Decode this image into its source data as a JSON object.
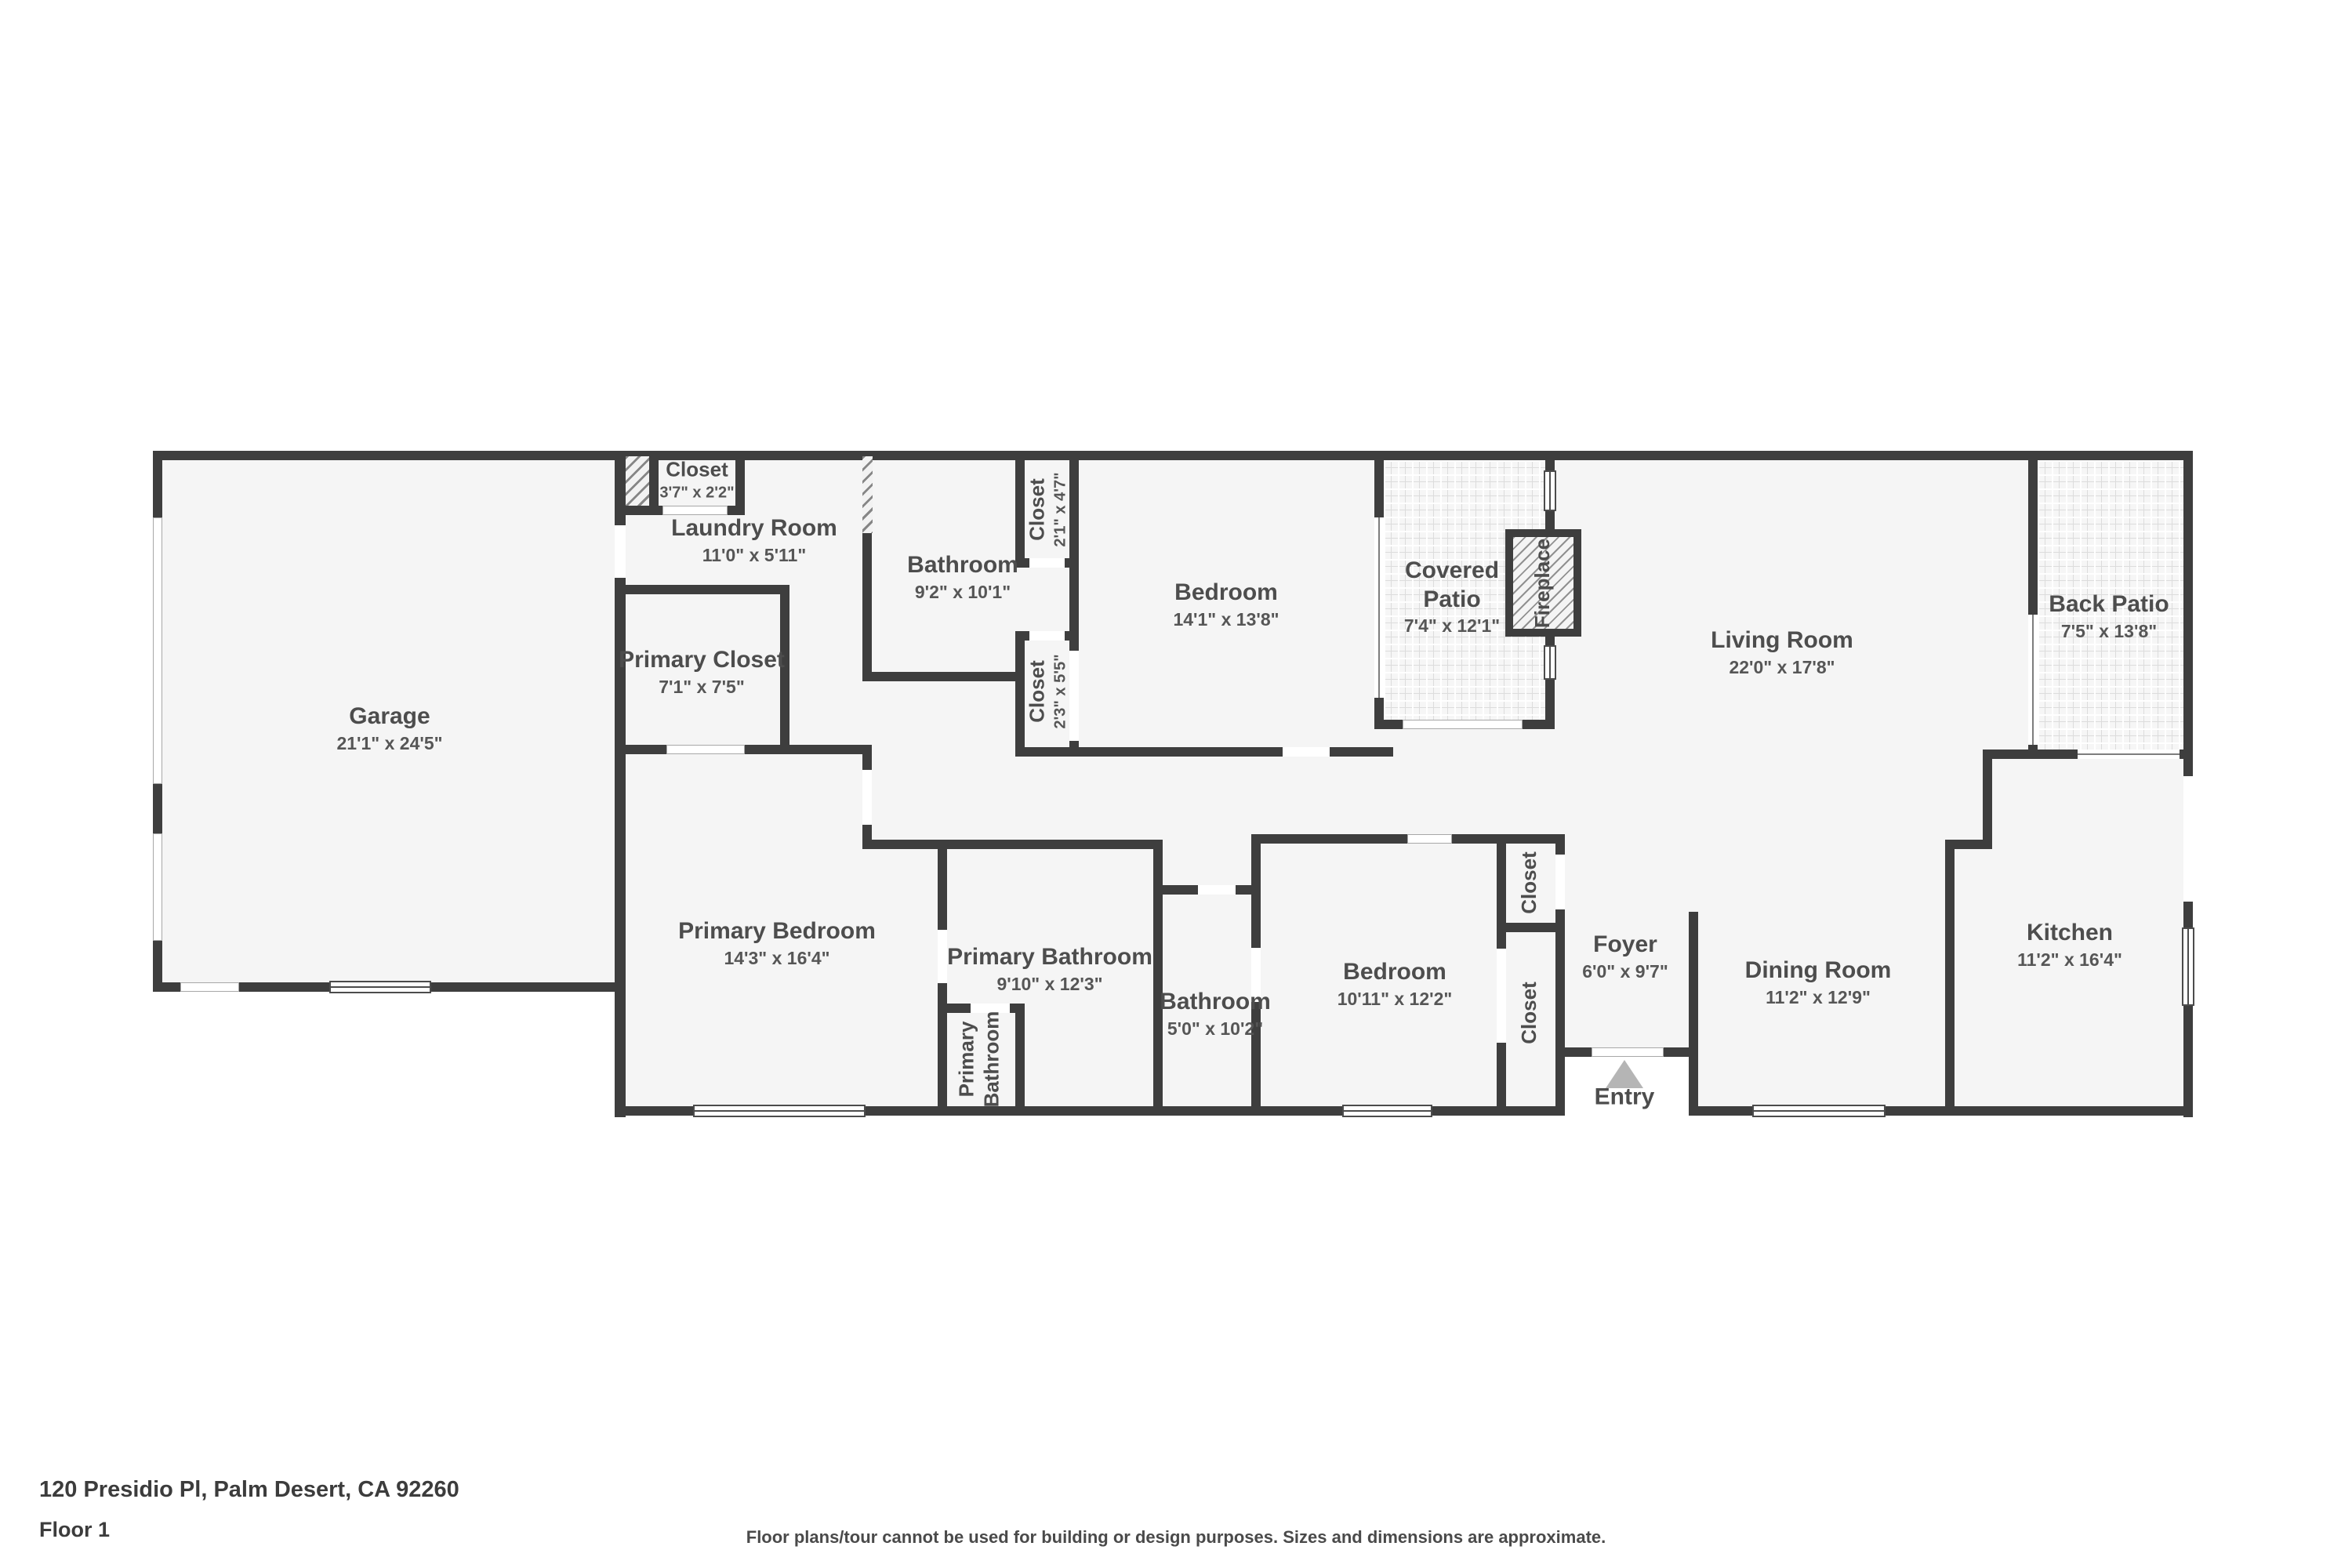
{
  "address": "120 Presidio Pl, Palm Desert, CA 92260",
  "floor_label": "Floor 1",
  "disclaimer": "Floor plans/tour cannot be used for building or design purposes. Sizes and dimensions are approximate.",
  "rooms": {
    "garage": {
      "name": "Garage",
      "dims": "21'1\" x 24'5\""
    },
    "closet_top": {
      "name": "Closet",
      "dims": "3'7\" x 2'2\""
    },
    "laundry": {
      "name": "Laundry Room",
      "dims": "11'0\" x 5'11\""
    },
    "bathroom_top": {
      "name": "Bathroom",
      "dims": "9'2\" x 10'1\""
    },
    "closet_21": {
      "name": "Closet",
      "dims": "2'1\" x 4'7\""
    },
    "closet_23": {
      "name": "Closet",
      "dims": "2'3\" x 5'5\""
    },
    "bedroom_top": {
      "name": "Bedroom",
      "dims": "14'1\" x 13'8\""
    },
    "covered_patio": {
      "name": "Covered Patio",
      "dims": "7'4\" x 12'1\""
    },
    "fireplace": {
      "name": "Fireplace"
    },
    "living": {
      "name": "Living Room",
      "dims": "22'0\" x 17'8\""
    },
    "back_patio": {
      "name": "Back Patio",
      "dims": "7'5\" x 13'8\""
    },
    "primary_closet": {
      "name": "Primary Closet",
      "dims": "7'1\" x 7'5\""
    },
    "primary_bedroom": {
      "name": "Primary Bedroom",
      "dims": "14'3\" x 16'4\""
    },
    "primary_bathroom": {
      "name": "Primary Bathroom",
      "dims": "9'10\" x 12'3\""
    },
    "primary_wc": {
      "name": "Primary Bathroom"
    },
    "bathroom_small": {
      "name": "Bathroom",
      "dims": "5'0\" x 10'2\""
    },
    "bedroom_small": {
      "name": "Bedroom",
      "dims": "10'11\" x 12'2\""
    },
    "closet_a": {
      "name": "Closet"
    },
    "closet_b": {
      "name": "Closet"
    },
    "foyer": {
      "name": "Foyer",
      "dims": "6'0\" x 9'7\""
    },
    "entry": {
      "name": "Entry"
    },
    "dining": {
      "name": "Dining Room",
      "dims": "11'2\" x 12'9\""
    },
    "kitchen": {
      "name": "Kitchen",
      "dims": "11'2\" x 16'4\""
    }
  },
  "colors": {
    "wall": "#3e3e3e",
    "floor": "#f5f5f5",
    "text": "#4d4d4d",
    "entry_triangle": "#b5b5b5"
  }
}
